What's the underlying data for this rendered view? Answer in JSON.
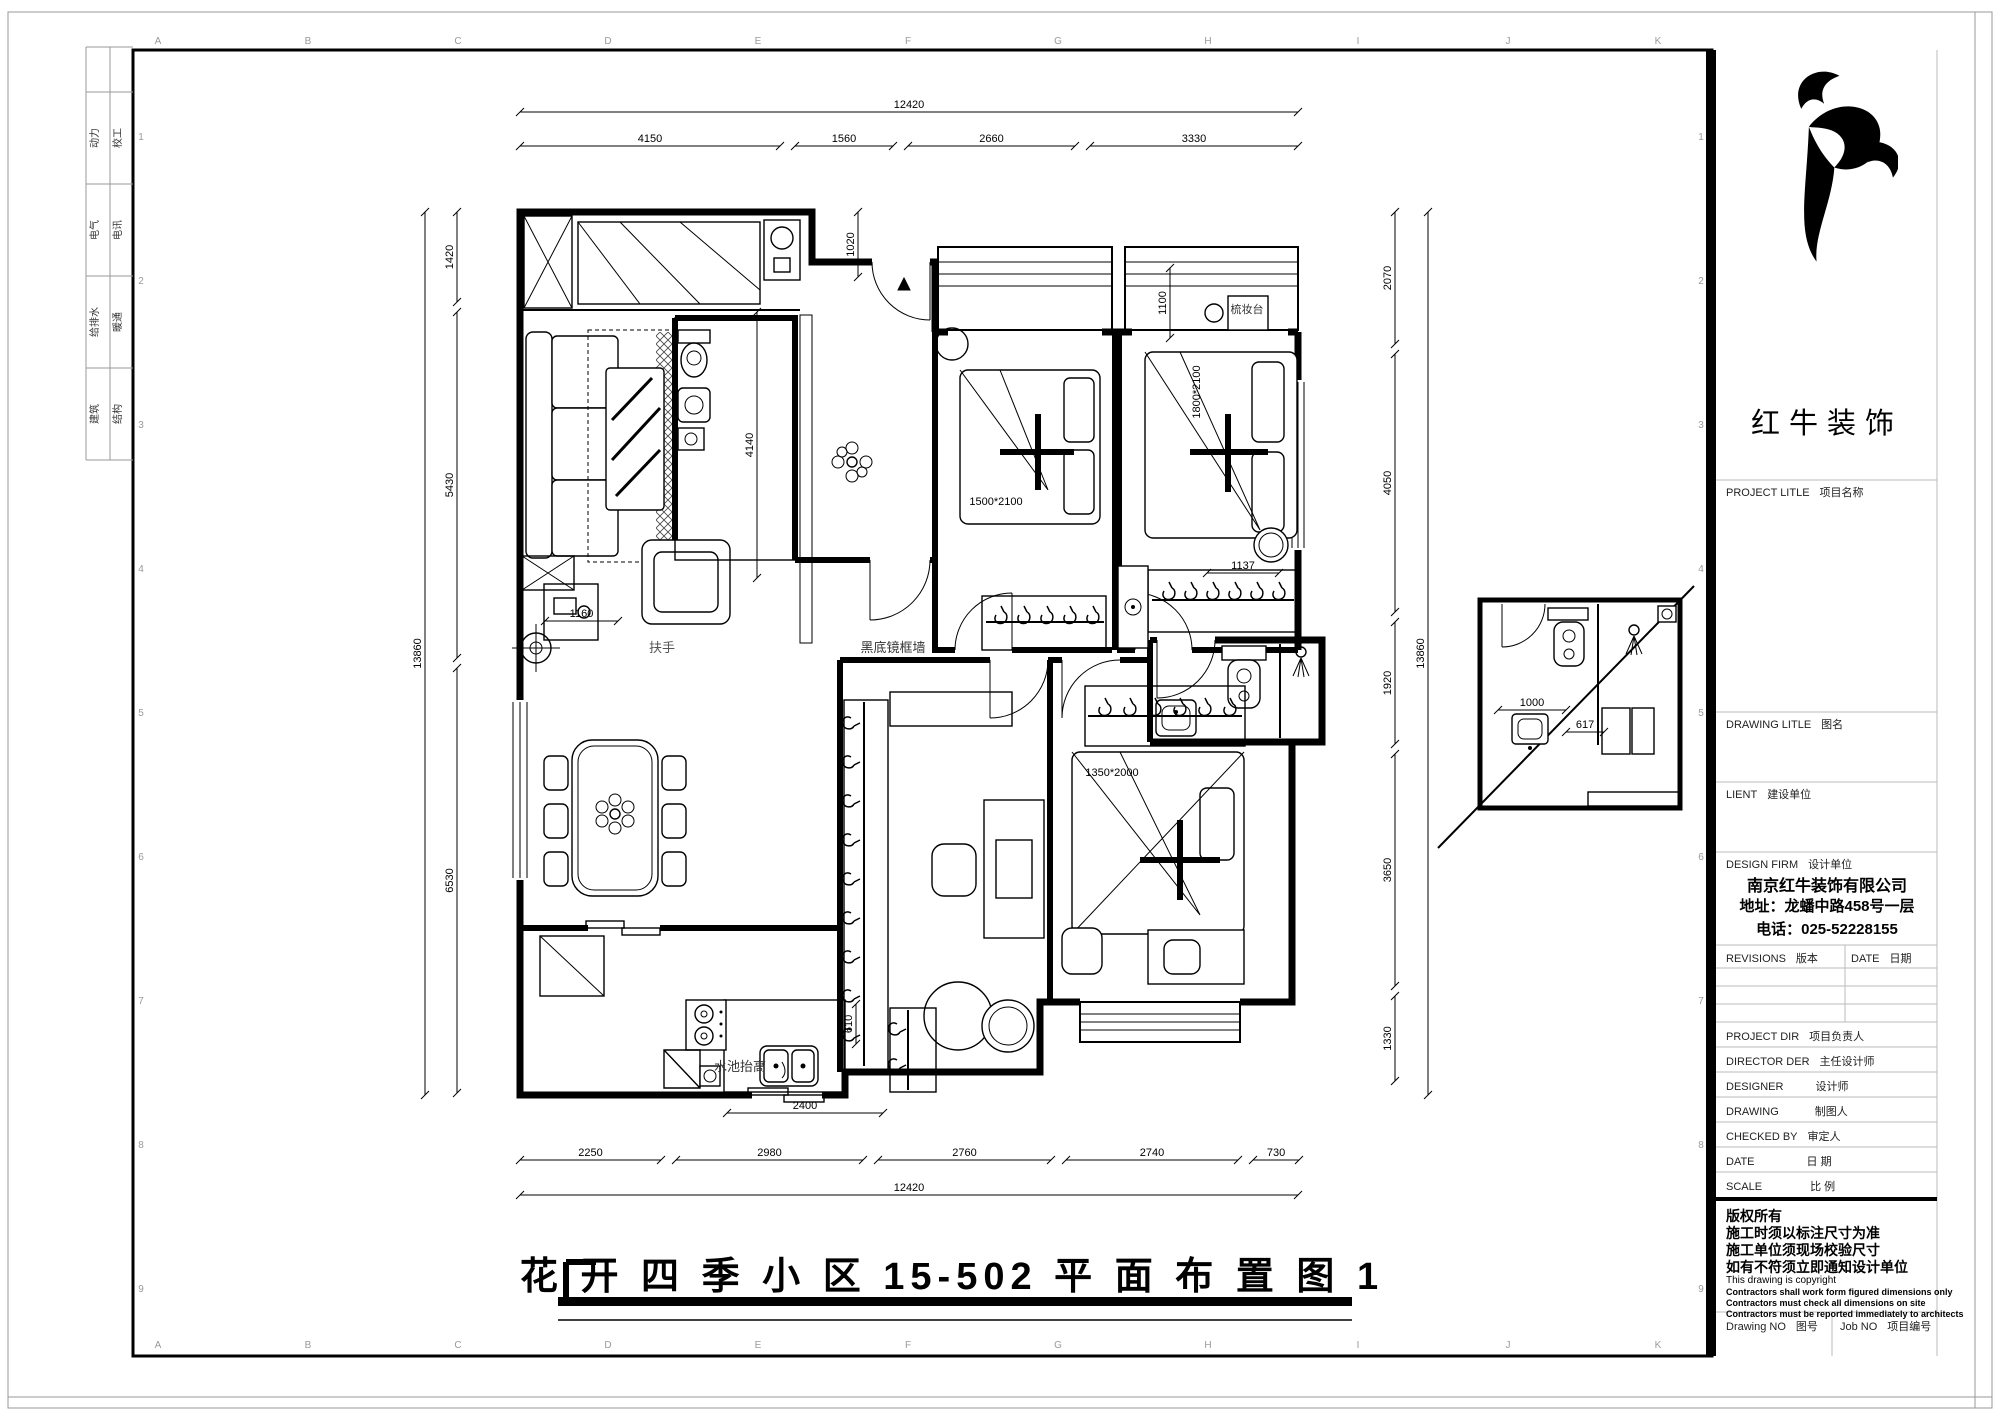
{
  "sheet": {
    "title": "花 开 四 季 小 区 15-502 平 面 布 置 图 1",
    "grid_letters": [
      "A",
      "B",
      "C",
      "D",
      "E",
      "F",
      "G",
      "H",
      "I",
      "J",
      "K"
    ],
    "grid_numbers": [
      "1",
      "2",
      "3",
      "4",
      "5",
      "6",
      "7",
      "8",
      "9"
    ],
    "discipline_labels": [
      [
        "动力",
        "校工"
      ],
      [
        "电气",
        "电讯"
      ],
      [
        "给排水",
        "暖通"
      ],
      [
        "建筑",
        "结构"
      ]
    ]
  },
  "plan": {
    "labels": [
      {
        "t": "扶手",
        "x": 662,
        "y": 652,
        "s": 13,
        "c": "#555"
      },
      {
        "t": "黑底镜框墙",
        "x": 893,
        "y": 652,
        "s": 13,
        "c": "#333"
      },
      {
        "t": "水池抬高",
        "x": 740,
        "y": 1071,
        "s": 13,
        "c": "#333"
      },
      {
        "t": "梳妆台",
        "x": 1247,
        "y": 313,
        "s": 11,
        "c": "#333"
      },
      {
        "t": "1500*2100",
        "x": 996,
        "y": 505,
        "s": 11
      },
      {
        "t": "1800*2100",
        "x": 1200,
        "y": 392,
        "s": 11,
        "r": -90
      },
      {
        "t": "1350*2000",
        "x": 1112,
        "y": 776,
        "s": 11
      },
      {
        "t": "花 开 四 季 小 区 15-502 平 面 布 置 图 1",
        "x": 952,
        "y": 1289,
        "s": 38,
        "b": 1,
        "ls": 6
      }
    ],
    "dimensions": [
      {
        "t": "12420",
        "x1": 520,
        "y1": 112,
        "x2": 1298,
        "y2": 112
      },
      {
        "t": "4150",
        "x1": 520,
        "y1": 146,
        "x2": 780,
        "y2": 146
      },
      {
        "t": "1560",
        "x1": 795,
        "y1": 146,
        "x2": 893,
        "y2": 146
      },
      {
        "t": "2660",
        "x1": 908,
        "y1": 146,
        "x2": 1075,
        "y2": 146
      },
      {
        "t": "3330",
        "x1": 1090,
        "y1": 146,
        "x2": 1298,
        "y2": 146
      },
      {
        "t": "2250",
        "x1": 520,
        "y1": 1160,
        "x2": 661,
        "y2": 1160
      },
      {
        "t": "2980",
        "x1": 676,
        "y1": 1160,
        "x2": 863,
        "y2": 1160
      },
      {
        "t": "2760",
        "x1": 878,
        "y1": 1160,
        "x2": 1051,
        "y2": 1160
      },
      {
        "t": "2740",
        "x1": 1066,
        "y1": 1160,
        "x2": 1238,
        "y2": 1160
      },
      {
        "t": "730",
        "x1": 1253,
        "y1": 1160,
        "x2": 1299,
        "y2": 1160
      },
      {
        "t": "12420",
        "x1": 520,
        "y1": 1195,
        "x2": 1298,
        "y2": 1195
      },
      {
        "t": "2400",
        "x1": 727,
        "y1": 1113,
        "x2": 883,
        "y2": 1113
      },
      {
        "t": "13860",
        "x1": 425,
        "y1": 212,
        "x2": 425,
        "y2": 1095
      },
      {
        "t": "1420",
        "x1": 457,
        "y1": 212,
        "x2": 457,
        "y2": 302
      },
      {
        "t": "5430",
        "x1": 457,
        "y1": 312,
        "x2": 457,
        "y2": 658
      },
      {
        "t": "6530",
        "x1": 457,
        "y1": 668,
        "x2": 457,
        "y2": 1093
      },
      {
        "t": "4140",
        "x1": 757,
        "y1": 312,
        "x2": 757,
        "y2": 578
      },
      {
        "t": "1160",
        "x1": 545,
        "y1": 621,
        "x2": 618,
        "y2": 621
      },
      {
        "t": "1020",
        "x1": 858,
        "y1": 212,
        "x2": 858,
        "y2": 277
      },
      {
        "t": "1100",
        "x1": 1170,
        "y1": 268,
        "x2": 1170,
        "y2": 338
      },
      {
        "t": "1137",
        "x1": 1207,
        "y1": 573,
        "x2": 1279,
        "y2": 573
      },
      {
        "t": "610",
        "x1": 856,
        "y1": 1004,
        "x2": 856,
        "y2": 1044
      },
      {
        "t": "2070",
        "x1": 1395,
        "y1": 212,
        "x2": 1395,
        "y2": 344
      },
      {
        "t": "4050",
        "x1": 1395,
        "y1": 354,
        "x2": 1395,
        "y2": 612
      },
      {
        "t": "1920",
        "x1": 1395,
        "y1": 622,
        "x2": 1395,
        "y2": 744
      },
      {
        "t": "3650",
        "x1": 1395,
        "y1": 754,
        "x2": 1395,
        "y2": 986
      },
      {
        "t": "1330",
        "x1": 1395,
        "y1": 996,
        "x2": 1395,
        "y2": 1081
      },
      {
        "t": "13860",
        "x1": 1428,
        "y1": 212,
        "x2": 1428,
        "y2": 1095
      },
      {
        "t": "1000",
        "x1": 1498,
        "y1": 710,
        "x2": 1566,
        "y2": 710
      },
      {
        "t": "617",
        "x1": 1566,
        "y1": 732,
        "x2": 1604,
        "y2": 732
      }
    ]
  },
  "titleblock": {
    "logo": {
      "name": "红牛装饰",
      "icon": "bull-swoosh"
    },
    "project": {
      "en": "PROJECT LITLE",
      "zh": "项目名称"
    },
    "drawing_title": {
      "en": "DRAWING LITLE",
      "zh": "图名"
    },
    "client": {
      "en": "LIENT",
      "zh": "建设单位"
    },
    "design_firm": {
      "en": "DESIGN FIRM",
      "zh": "设计单位"
    },
    "company": {
      "name": "南京红牛装饰有限公司",
      "address": "地址：龙蟠中路458号一层",
      "phone": "电话：025-52228155"
    },
    "revisions": {
      "en": "REVISIONS",
      "zh": "版本"
    },
    "rev_date": {
      "en": "DATE",
      "zh": "日期"
    },
    "project_dir": {
      "en": "PROJECT DIR",
      "zh": "项目负责人"
    },
    "director": {
      "en": "DIRECTOR DER",
      "zh": "主任设计师"
    },
    "designer": {
      "en": "DESIGNER",
      "zh": "设计师"
    },
    "drawing_person": {
      "en": "DRAWING",
      "zh": "制图人"
    },
    "checked_by": {
      "en": "CHECKED BY",
      "zh": "审定人"
    },
    "date_row": {
      "en": "DATE",
      "zh": "日  期"
    },
    "scale_row": {
      "en": "SCALE",
      "zh": "比  例"
    },
    "copyright_cn": [
      "版权所有",
      "施工时须以标注尺寸为准",
      "施工单位须现场校验尺寸",
      "如有不符须立即通知设计单位"
    ],
    "copyright_en": [
      "This drawing is copyright",
      "Contractors shall work form figured dimensions only",
      "Contractors must check all dimensions on site",
      "Contractors must be reported immediately to architects"
    ],
    "drawing_no": {
      "en": "Drawing NO",
      "zh": "图号"
    },
    "job_no": {
      "en": "Job NO",
      "zh": "项目编号"
    }
  }
}
